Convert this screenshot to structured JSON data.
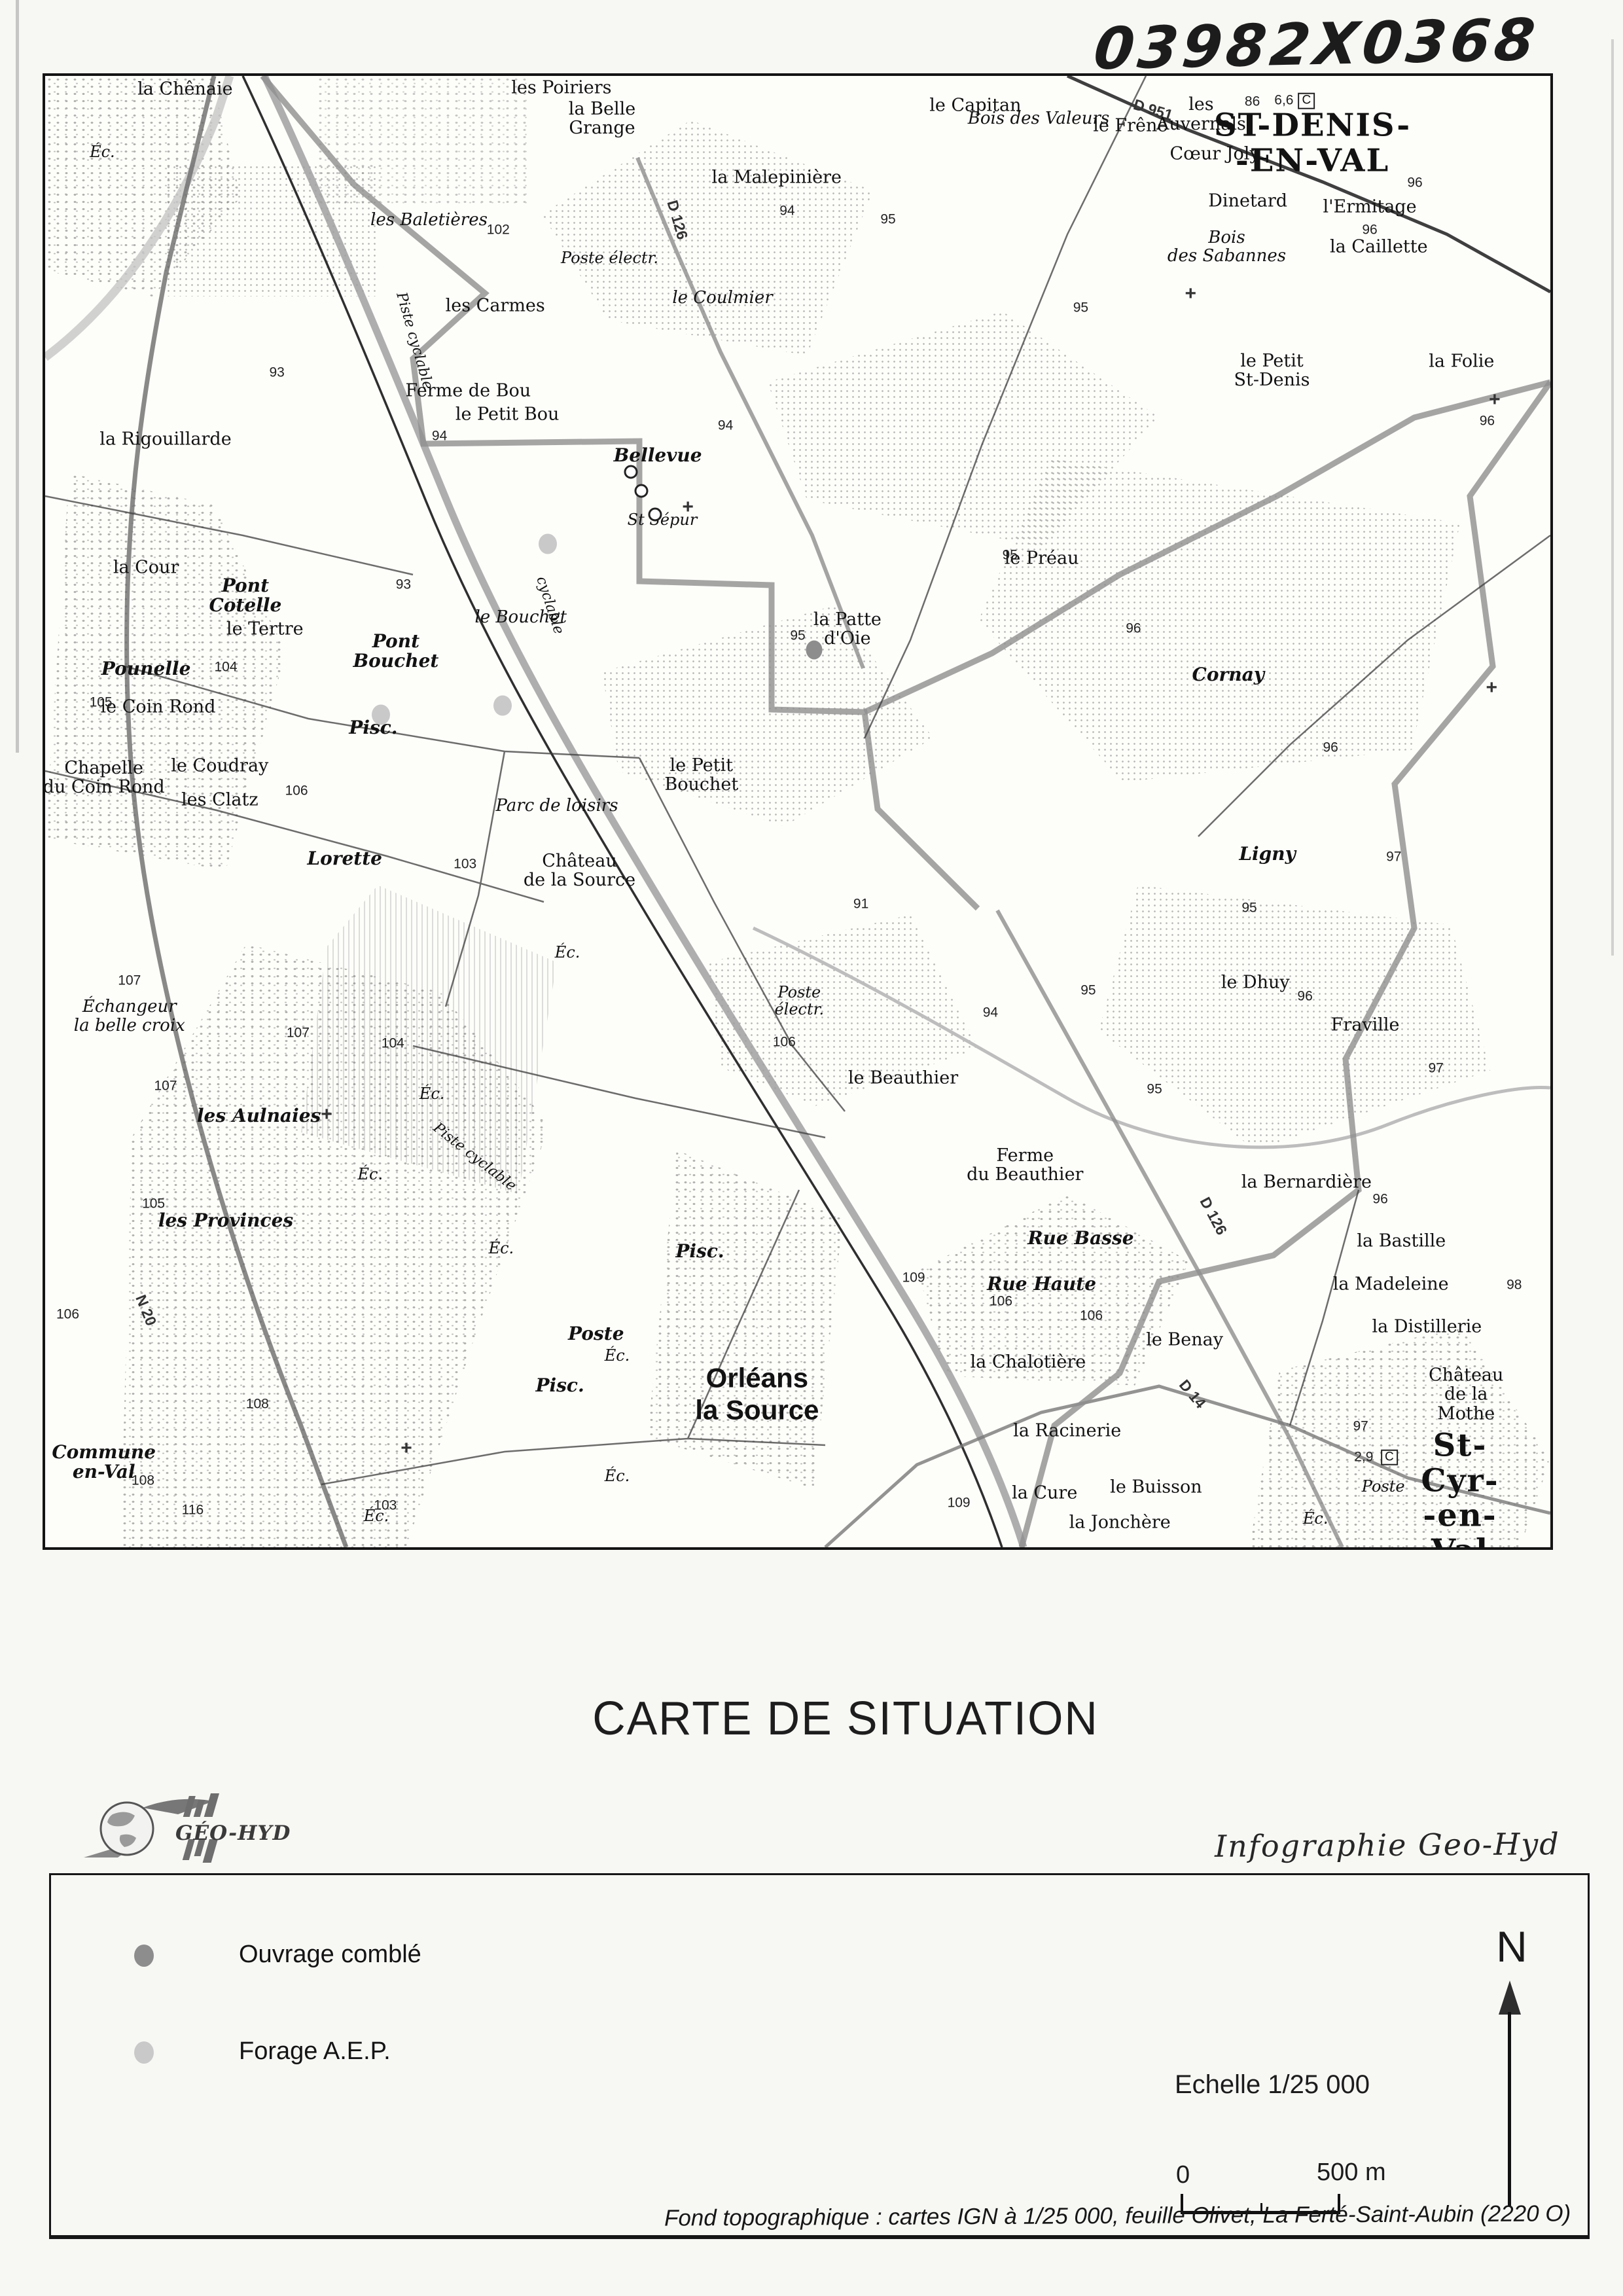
{
  "annotation": "03982X0368",
  "title": "CARTE DE SITUATION",
  "credit": "Infographie Geo-Hyd",
  "logo_text": "GÉO-HYD",
  "legend": {
    "items": [
      {
        "label": "Ouvrage comblé",
        "color": "#8d8d8d"
      },
      {
        "label": "Forage A.E.P.",
        "color": "#c9c9c9"
      }
    ],
    "scale_label": "Echelle 1/25 000",
    "scale_zero": "0",
    "scale_end": "500 m",
    "north": "N"
  },
  "footer": "Fond topographique : cartes IGN à 1/25 000, feuille Olivet,  La Ferté-Saint-Aubin (2220 O)",
  "map": {
    "labels": [
      {
        "t": "la Chênaie",
        "x": 9.3,
        "y": 0.9,
        "c": "p"
      },
      {
        "t": "les Poiriers",
        "x": 34.3,
        "y": 0.8,
        "c": "p"
      },
      {
        "t": "la Belle\nGrange",
        "x": 37.0,
        "y": 2.9,
        "c": "p"
      },
      {
        "t": "le Capitan",
        "x": 61.8,
        "y": 2.0,
        "c": "p"
      },
      {
        "t": "la Malepinière",
        "x": 48.6,
        "y": 6.9,
        "c": "p"
      },
      {
        "t": "les Baletières",
        "x": 25.5,
        "y": 9.8,
        "c": "w"
      },
      {
        "t": "les Carmes",
        "x": 29.9,
        "y": 15.6,
        "c": "p"
      },
      {
        "t": "Poste électr.",
        "x": 37.5,
        "y": 12.4,
        "c": "sm"
      },
      {
        "t": "le Coulmier",
        "x": 45.0,
        "y": 15.1,
        "c": "w"
      },
      {
        "t": "Ferme de Bou",
        "x": 28.1,
        "y": 21.4,
        "c": "p"
      },
      {
        "t": "le Petit Bou",
        "x": 30.7,
        "y": 23.0,
        "c": "p"
      },
      {
        "t": "Bellevue",
        "x": 40.7,
        "y": 25.8,
        "c": "b"
      },
      {
        "t": "la Rigouillarde",
        "x": 8.0,
        "y": 24.7,
        "c": "p"
      },
      {
        "t": "St Sépur",
        "x": 41.0,
        "y": 30.2,
        "c": "sm"
      },
      {
        "t": "le Préau",
        "x": 66.2,
        "y": 32.8,
        "c": "p"
      },
      {
        "t": "la Patte\nd'Oie",
        "x": 53.3,
        "y": 37.6,
        "c": "p"
      },
      {
        "t": "Cornay",
        "x": 78.6,
        "y": 40.7,
        "c": "b"
      },
      {
        "t": "le Bouchet",
        "x": 31.6,
        "y": 36.8,
        "c": "w"
      },
      {
        "t": "Pont\nCotelle",
        "x": 13.3,
        "y": 35.3,
        "c": "b"
      },
      {
        "t": "le Tertre",
        "x": 14.6,
        "y": 37.6,
        "c": "p"
      },
      {
        "t": "Pounelle",
        "x": 6.7,
        "y": 40.3,
        "c": "b"
      },
      {
        "t": "le Coin Rond",
        "x": 7.5,
        "y": 42.9,
        "c": "p"
      },
      {
        "t": "Chapelle\ndu Coin Rond",
        "x": 3.9,
        "y": 47.7,
        "c": "p"
      },
      {
        "t": "le Coudray",
        "x": 11.6,
        "y": 46.9,
        "c": "p"
      },
      {
        "t": "les Clatz",
        "x": 11.6,
        "y": 49.2,
        "c": "p"
      },
      {
        "t": "la Cour",
        "x": 6.7,
        "y": 33.4,
        "c": "p"
      },
      {
        "t": "Pont\nBouchet",
        "x": 23.3,
        "y": 39.1,
        "c": "b"
      },
      {
        "t": "le Petit\nBouchet",
        "x": 43.6,
        "y": 47.5,
        "c": "p"
      },
      {
        "t": "Parc de loisirs",
        "x": 34.0,
        "y": 49.6,
        "c": "w"
      },
      {
        "t": "Château\nde la Source",
        "x": 35.5,
        "y": 54.0,
        "c": "p"
      },
      {
        "t": "Lorette",
        "x": 19.9,
        "y": 53.2,
        "c": "b"
      },
      {
        "t": "Ligny",
        "x": 81.2,
        "y": 52.9,
        "c": "b"
      },
      {
        "t": "le Dhuy",
        "x": 80.4,
        "y": 61.6,
        "c": "p"
      },
      {
        "t": "Fraville",
        "x": 87.7,
        "y": 64.5,
        "c": "p"
      },
      {
        "t": "Poste\nélectr.",
        "x": 50.1,
        "y": 62.9,
        "c": "sm"
      },
      {
        "t": "le Beauthier",
        "x": 57.0,
        "y": 68.1,
        "c": "p"
      },
      {
        "t": "Ferme\ndu Beauthier",
        "x": 65.1,
        "y": 74.0,
        "c": "p"
      },
      {
        "t": "la Bernardière",
        "x": 83.8,
        "y": 75.2,
        "c": "p"
      },
      {
        "t": "la Bastille",
        "x": 90.1,
        "y": 79.2,
        "c": "p"
      },
      {
        "t": "la Madeleine",
        "x": 89.4,
        "y": 82.1,
        "c": "p"
      },
      {
        "t": "la Distillerie",
        "x": 91.8,
        "y": 85.0,
        "c": "p"
      },
      {
        "t": "Rue Basse",
        "x": 68.8,
        "y": 79.0,
        "c": "b"
      },
      {
        "t": "Rue Haute",
        "x": 66.2,
        "y": 82.1,
        "c": "b"
      },
      {
        "t": "le Benay",
        "x": 75.7,
        "y": 85.9,
        "c": "p"
      },
      {
        "t": "la Chalotière",
        "x": 65.3,
        "y": 87.4,
        "c": "p"
      },
      {
        "t": "la Racinerie",
        "x": 67.9,
        "y": 92.1,
        "c": "p"
      },
      {
        "t": "le Buisson",
        "x": 73.8,
        "y": 95.9,
        "c": "p"
      },
      {
        "t": "la Cure",
        "x": 66.4,
        "y": 96.3,
        "c": "p"
      },
      {
        "t": "la Jonchère",
        "x": 71.4,
        "y": 98.3,
        "c": "p"
      },
      {
        "t": "les Provinces",
        "x": 12.0,
        "y": 77.8,
        "c": "b"
      },
      {
        "t": "Commune\nen-Val",
        "x": 3.9,
        "y": 94.2,
        "c": "b"
      },
      {
        "t": "les Aulnaies",
        "x": 14.2,
        "y": 70.7,
        "c": "b"
      },
      {
        "t": "Échangeur\nla belle croix",
        "x": 5.6,
        "y": 63.9,
        "c": "w"
      },
      {
        "t": "Orléans\nla Source",
        "x": 47.3,
        "y": 89.6,
        "c": "t2"
      },
      {
        "t": "ST-DENIS-\n-EN-VAL",
        "x": 84.2,
        "y": 4.6,
        "c": "t1"
      },
      {
        "t": "St-Cyr-\n-en-Val",
        "x": 94.0,
        "y": 96.7,
        "c": "t1"
      },
      {
        "t": "Château\nde la Mothe",
        "x": 94.4,
        "y": 89.6,
        "c": "p"
      },
      {
        "t": "Dinetard",
        "x": 79.9,
        "y": 8.5,
        "c": "p"
      },
      {
        "t": "l'Ermitage",
        "x": 88.0,
        "y": 8.9,
        "c": "p"
      },
      {
        "t": "Bois\ndes Sabannes",
        "x": 78.5,
        "y": 11.6,
        "c": "w"
      },
      {
        "t": "la Caillette",
        "x": 88.6,
        "y": 11.6,
        "c": "p"
      },
      {
        "t": "le Petit\nSt-Denis",
        "x": 81.5,
        "y": 20.0,
        "c": "p"
      },
      {
        "t": "la Folie",
        "x": 94.1,
        "y": 19.4,
        "c": "p"
      },
      {
        "t": "Bois des Valeurs",
        "x": 66.0,
        "y": 2.9,
        "c": "w"
      },
      {
        "t": "le Frêne",
        "x": 72.1,
        "y": 3.4,
        "c": "p"
      },
      {
        "t": "les\nAuvernals",
        "x": 76.8,
        "y": 2.6,
        "c": "p"
      },
      {
        "t": "Cœur Joly",
        "x": 77.7,
        "y": 5.3,
        "c": "p"
      },
      {
        "t": "Éc.",
        "x": 3.8,
        "y": 5.2,
        "c": "sm"
      },
      {
        "t": "Éc.",
        "x": 34.7,
        "y": 59.6,
        "c": "sm"
      },
      {
        "t": "Éc.",
        "x": 25.7,
        "y": 69.2,
        "c": "sm"
      },
      {
        "t": "Éc.",
        "x": 21.6,
        "y": 74.7,
        "c": "sm"
      },
      {
        "t": "Éc.",
        "x": 30.3,
        "y": 79.7,
        "c": "sm"
      },
      {
        "t": "Éc.",
        "x": 38.0,
        "y": 87.0,
        "c": "sm"
      },
      {
        "t": "Éc.",
        "x": 38.0,
        "y": 95.2,
        "c": "sm"
      },
      {
        "t": "Éc.",
        "x": 22.0,
        "y": 97.9,
        "c": "sm"
      },
      {
        "t": "Éc.",
        "x": 84.4,
        "y": 98.1,
        "c": "sm"
      },
      {
        "t": "Poste",
        "x": 36.6,
        "y": 85.5,
        "c": "b"
      },
      {
        "t": "Poste",
        "x": 88.9,
        "y": 95.9,
        "c": "sm"
      },
      {
        "t": "Pisc.",
        "x": 21.8,
        "y": 44.3,
        "c": "b"
      },
      {
        "t": "Pisc.",
        "x": 43.5,
        "y": 79.9,
        "c": "b"
      },
      {
        "t": "Pisc.",
        "x": 34.2,
        "y": 89.0,
        "c": "b"
      },
      {
        "t": "D 951",
        "x": 73.6,
        "y": 2.3,
        "c": "rd",
        "r": 17
      },
      {
        "t": "D 126",
        "x": 42.0,
        "y": 9.8,
        "c": "rd",
        "r": 74
      },
      {
        "t": "D 126",
        "x": 77.6,
        "y": 77.5,
        "c": "rd",
        "r": 62
      },
      {
        "t": "D 14",
        "x": 76.2,
        "y": 89.6,
        "c": "rd",
        "r": 50
      },
      {
        "t": "N 20",
        "x": 6.7,
        "y": 83.9,
        "c": "rd",
        "r": 68
      },
      {
        "t": "Piste cyclable",
        "x": 24.5,
        "y": 18.0,
        "c": "w",
        "r": 74,
        "fs": 22
      },
      {
        "t": "cyclable",
        "x": 33.5,
        "y": 36.0,
        "c": "w",
        "r": 72,
        "fs": 22
      },
      {
        "t": "Piste cyclable",
        "x": 28.5,
        "y": 73.5,
        "c": "w",
        "r": 38,
        "fs": 22
      },
      {
        "t": "86",
        "x": 80.2,
        "y": 1.8,
        "c": "s"
      },
      {
        "t": "6,6",
        "x": 82.3,
        "y": 1.7,
        "c": "s"
      },
      {
        "t": "C",
        "x": 83.8,
        "y": 1.7,
        "c": "cbox"
      },
      {
        "t": "2,9",
        "x": 87.6,
        "y": 93.9,
        "c": "s"
      },
      {
        "t": "C",
        "x": 89.3,
        "y": 93.9,
        "c": "cbox"
      },
      {
        "t": "97",
        "x": 87.4,
        "y": 91.8,
        "c": "s"
      },
      {
        "t": "93",
        "x": 15.4,
        "y": 20.2,
        "c": "s"
      },
      {
        "t": "93",
        "x": 23.8,
        "y": 34.6,
        "c": "s"
      },
      {
        "t": "94",
        "x": 26.2,
        "y": 24.5,
        "c": "s"
      },
      {
        "t": "94",
        "x": 45.2,
        "y": 23.8,
        "c": "s"
      },
      {
        "t": "94",
        "x": 49.3,
        "y": 9.2,
        "c": "s"
      },
      {
        "t": "94",
        "x": 62.8,
        "y": 63.7,
        "c": "s"
      },
      {
        "t": "91",
        "x": 54.2,
        "y": 56.3,
        "c": "s"
      },
      {
        "t": "95",
        "x": 56.0,
        "y": 9.8,
        "c": "s"
      },
      {
        "t": "95",
        "x": 68.8,
        "y": 15.8,
        "c": "s"
      },
      {
        "t": "95",
        "x": 50.0,
        "y": 38.1,
        "c": "s"
      },
      {
        "t": "95",
        "x": 64.1,
        "y": 32.6,
        "c": "s"
      },
      {
        "t": "95",
        "x": 80.0,
        "y": 56.6,
        "c": "s"
      },
      {
        "t": "95",
        "x": 69.3,
        "y": 62.2,
        "c": "s"
      },
      {
        "t": "95",
        "x": 73.7,
        "y": 68.9,
        "c": "s"
      },
      {
        "t": "96",
        "x": 88.0,
        "y": 10.5,
        "c": "s"
      },
      {
        "t": "96",
        "x": 91.0,
        "y": 7.3,
        "c": "s"
      },
      {
        "t": "96",
        "x": 95.8,
        "y": 23.5,
        "c": "s"
      },
      {
        "t": "96",
        "x": 72.3,
        "y": 37.6,
        "c": "s"
      },
      {
        "t": "96",
        "x": 85.4,
        "y": 45.7,
        "c": "s"
      },
      {
        "t": "96",
        "x": 83.7,
        "y": 62.6,
        "c": "s"
      },
      {
        "t": "96",
        "x": 88.7,
        "y": 76.4,
        "c": "s"
      },
      {
        "t": "97",
        "x": 89.6,
        "y": 53.1,
        "c": "s"
      },
      {
        "t": "97",
        "x": 92.4,
        "y": 67.5,
        "c": "s"
      },
      {
        "t": "98",
        "x": 97.6,
        "y": 82.2,
        "c": "s"
      },
      {
        "t": "102",
        "x": 30.1,
        "y": 10.5,
        "c": "s"
      },
      {
        "t": "103",
        "x": 27.9,
        "y": 53.6,
        "c": "s"
      },
      {
        "t": "103",
        "x": 22.6,
        "y": 97.2,
        "c": "s"
      },
      {
        "t": "104",
        "x": 12.0,
        "y": 40.2,
        "c": "s"
      },
      {
        "t": "104",
        "x": 23.1,
        "y": 65.8,
        "c": "s"
      },
      {
        "t": "105",
        "x": 3.7,
        "y": 42.6,
        "c": "s"
      },
      {
        "t": "105",
        "x": 7.2,
        "y": 76.7,
        "c": "s"
      },
      {
        "t": "106",
        "x": 16.7,
        "y": 48.6,
        "c": "s"
      },
      {
        "t": "106",
        "x": 1.5,
        "y": 84.2,
        "c": "s"
      },
      {
        "t": "106",
        "x": 49.1,
        "y": 65.7,
        "c": "s"
      },
      {
        "t": "106",
        "x": 63.5,
        "y": 83.3,
        "c": "s"
      },
      {
        "t": "106",
        "x": 69.5,
        "y": 84.3,
        "c": "s"
      },
      {
        "t": "107",
        "x": 5.6,
        "y": 61.5,
        "c": "s"
      },
      {
        "t": "107",
        "x": 8.0,
        "y": 68.7,
        "c": "s"
      },
      {
        "t": "107",
        "x": 16.8,
        "y": 65.1,
        "c": "s"
      },
      {
        "t": "108",
        "x": 14.1,
        "y": 90.3,
        "c": "s"
      },
      {
        "t": "108",
        "x": 6.5,
        "y": 95.5,
        "c": "s"
      },
      {
        "t": "109",
        "x": 57.7,
        "y": 81.7,
        "c": "s"
      },
      {
        "t": "109",
        "x": 60.7,
        "y": 97.0,
        "c": "s"
      },
      {
        "t": "116",
        "x": 9.8,
        "y": 97.5,
        "c": "s"
      },
      {
        "t": "+",
        "x": 76.1,
        "y": 14.8,
        "c": "cr"
      },
      {
        "t": "+",
        "x": 96.1,
        "y": 41.6,
        "c": "cr"
      },
      {
        "t": "+",
        "x": 96.3,
        "y": 22.0,
        "c": "cr"
      },
      {
        "t": "+",
        "x": 42.7,
        "y": 29.3,
        "c": "cr"
      },
      {
        "t": "+",
        "x": 18.7,
        "y": 70.6,
        "c": "cr"
      },
      {
        "t": "+",
        "x": 24.0,
        "y": 93.3,
        "c": "cr"
      }
    ],
    "markers": [
      {
        "k": "dark",
        "x": 51.1,
        "y": 39.0
      },
      {
        "k": "light",
        "x": 22.3,
        "y": 43.4
      },
      {
        "k": "light",
        "x": 30.4,
        "y": 42.8
      },
      {
        "k": "light",
        "x": 33.4,
        "y": 31.8
      },
      {
        "k": "well",
        "x": 39.6,
        "y": 28.2
      },
      {
        "k": "well",
        "x": 40.5,
        "y": 29.8
      },
      {
        "k": "well",
        "x": 38.9,
        "y": 26.9
      }
    ]
  }
}
